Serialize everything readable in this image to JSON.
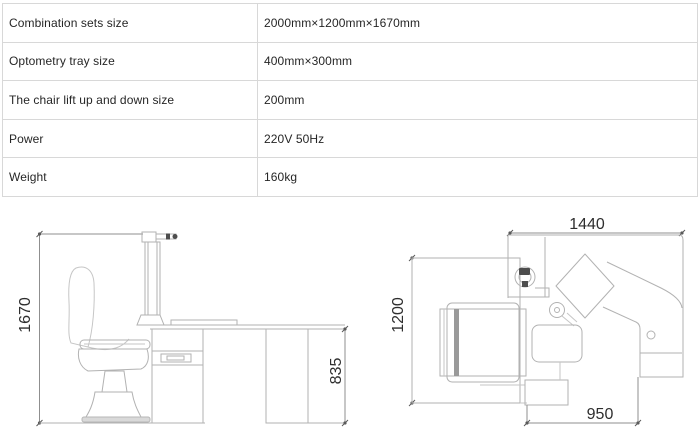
{
  "spec_table": {
    "rows": [
      {
        "label": "Combination sets size",
        "value": "2000mm×1200mm×1670mm"
      },
      {
        "label": "Optometry tray size",
        "value": "400mm×300mm"
      },
      {
        "label": "The chair lift up and down size",
        "value": "200mm"
      },
      {
        "label": "Power",
        "value": "220V 50Hz"
      },
      {
        "label": "Weight",
        "value": "160kg"
      }
    ]
  },
  "drawings": {
    "side_view": {
      "name": "chair-and-desk-side-view",
      "overall_height_mm": "1670",
      "desk_height_mm": "835"
    },
    "top_view": {
      "name": "chair-and-desk-top-view",
      "overall_width_mm": "1440",
      "overall_depth_mm": "1200",
      "desk_width_mm": "950"
    }
  },
  "colors": {
    "table_border": "#d8d8d8",
    "text": "#262626",
    "outline": "#b2b2b2",
    "dimension": "#8f8f8f",
    "dimension_text": "#2e2e2e"
  }
}
